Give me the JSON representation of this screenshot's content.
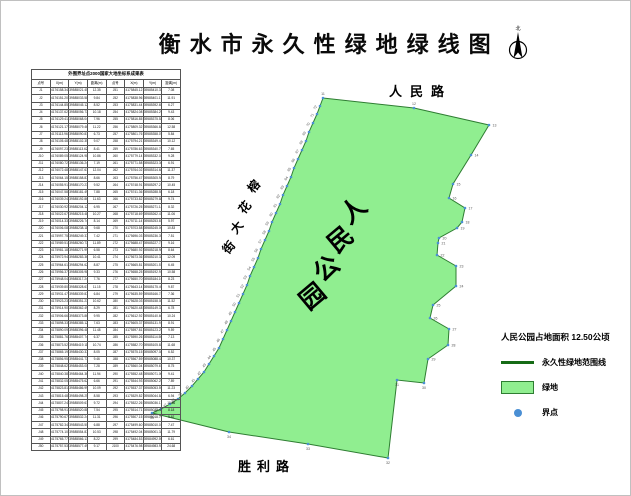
{
  "title": "衡水市永久性绿地绿线图",
  "north": {
    "label": "北"
  },
  "map": {
    "road_top": "人民路",
    "road_bottom": "胜利路",
    "street_left": "榕花大街",
    "street_chars": [
      {
        "ch": "榕",
        "x": 256,
        "y": 188
      },
      {
        "ch": "花",
        "x": 247,
        "y": 209
      },
      {
        "ch": "大",
        "x": 239,
        "y": 229
      },
      {
        "ch": "街",
        "x": 231,
        "y": 249
      }
    ],
    "park_name": "人民公园",
    "park_chars": [
      {
        "ch": "人",
        "x": 358,
        "y": 216
      },
      {
        "ch": "民",
        "x": 345,
        "y": 245
      },
      {
        "ch": "公",
        "x": 331,
        "y": 274
      },
      {
        "ch": "园",
        "x": 317,
        "y": 302
      }
    ],
    "polygon_points": "322,97 413,107 488,124 470,154 452,183 448,197 464,207 461,221 456,227 438,237 437,242 436,254 455,265 455,285 432,304 429,317 448,328 447,344 427,358 423,382 396,379 387,457 307,443 228,431 151,412 160,408 169,403 177,398 184,392 191,385 197,378 203,371 208,363 213,355 218,347 222,338 226,329 230,320 234,311 238,302 242,293 246,284 249,275 253,266 257,257 260,248 264,239 268,230 271,221 275,212 279,203 282,194 286,185 290,176 293,167 297,158 301,149 305,140 308,131 312,122 316,113 319,105",
    "fill_color": "#90ee90",
    "stroke_color": "#2e7d32",
    "dot_color": "#4a8fd4",
    "points": [
      [
        322,
        97,
        "11",
        "t"
      ],
      [
        413,
        107,
        "12",
        "t"
      ],
      [
        488,
        124,
        "13",
        "r"
      ],
      [
        470,
        154,
        "14",
        "r"
      ],
      [
        452,
        183,
        "15",
        "r"
      ],
      [
        448,
        197,
        "16",
        "r"
      ],
      [
        464,
        207,
        "17",
        "r"
      ],
      [
        461,
        221,
        "18",
        "r"
      ],
      [
        456,
        227,
        "19",
        "r"
      ],
      [
        438,
        237,
        "20",
        "r"
      ],
      [
        437,
        242,
        "21",
        "r"
      ],
      [
        436,
        254,
        "22",
        "r"
      ],
      [
        455,
        265,
        "23",
        "r"
      ],
      [
        455,
        285,
        "24",
        "r"
      ],
      [
        432,
        304,
        "25",
        "r"
      ],
      [
        429,
        317,
        "26",
        "r"
      ],
      [
        448,
        328,
        "27",
        "r"
      ],
      [
        447,
        344,
        "28",
        "r"
      ],
      [
        427,
        358,
        "29",
        "r"
      ],
      [
        423,
        382,
        "30",
        "b"
      ],
      [
        396,
        379,
        "31",
        "b"
      ],
      [
        387,
        457,
        "32",
        "b"
      ],
      [
        307,
        443,
        "33",
        "b"
      ],
      [
        228,
        431,
        "34",
        "b"
      ],
      [
        151,
        412,
        "35",
        "b"
      ],
      [
        160,
        408,
        "36",
        "rot"
      ],
      [
        169,
        403,
        "37",
        "rot"
      ],
      [
        177,
        398,
        "38",
        "rot"
      ],
      [
        184,
        392,
        "39",
        "rot"
      ],
      [
        191,
        385,
        "40",
        "rot"
      ],
      [
        197,
        378,
        "41",
        "rot"
      ],
      [
        203,
        371,
        "42",
        "rot"
      ],
      [
        208,
        363,
        "43",
        "rot"
      ],
      [
        213,
        355,
        "44",
        "rot"
      ],
      [
        218,
        347,
        "45",
        "rot"
      ],
      [
        222,
        338,
        "46",
        "rot"
      ],
      [
        226,
        329,
        "47",
        "rot"
      ],
      [
        230,
        320,
        "48",
        "rot"
      ],
      [
        234,
        311,
        "49",
        "rot"
      ],
      [
        238,
        302,
        "50",
        "rot"
      ],
      [
        242,
        293,
        "51",
        "rot"
      ],
      [
        246,
        284,
        "52",
        "rot"
      ],
      [
        249,
        275,
        "53",
        "rot"
      ],
      [
        253,
        266,
        "54",
        "rot"
      ],
      [
        257,
        257,
        "55",
        "rot"
      ],
      [
        260,
        248,
        "56",
        "rot"
      ],
      [
        264,
        239,
        "57",
        "rot"
      ],
      [
        268,
        230,
        "58",
        "rot"
      ],
      [
        271,
        221,
        "59",
        "rot"
      ],
      [
        275,
        212,
        "60",
        "rot"
      ],
      [
        279,
        203,
        "61",
        "rot"
      ],
      [
        282,
        194,
        "62",
        "rot"
      ],
      [
        286,
        185,
        "63",
        "rot"
      ],
      [
        290,
        176,
        "64",
        "rot"
      ],
      [
        293,
        167,
        "65",
        "rot"
      ],
      [
        297,
        158,
        "66",
        "rot"
      ],
      [
        301,
        149,
        "67",
        "rot"
      ],
      [
        305,
        140,
        "68",
        "rot"
      ],
      [
        308,
        131,
        "69",
        "rot"
      ],
      [
        312,
        122,
        "70",
        "rot"
      ],
      [
        316,
        113,
        "71",
        "rot"
      ],
      [
        319,
        105,
        "72",
        "rot"
      ]
    ]
  },
  "legend": {
    "area_note": "人民公园占地面积  12.50公顷",
    "items": [
      {
        "type": "line",
        "label": "永久性绿地范围线",
        "color": "#166b16"
      },
      {
        "type": "fill",
        "label": "绿地",
        "color": "#90ee90"
      },
      {
        "type": "dot",
        "label": "界点",
        "color": "#4a8fd4"
      }
    ]
  },
  "table": {
    "title": "外围界址点2000国家大地坐标系成果表",
    "headers": [
      "点号",
      "X(m)",
      "Y(m)",
      "距离(m)"
    ],
    "rows": [
      [
        "J1",
        "4176158.34",
        "39585021.45",
        "12.35",
        "J51",
        "4175845.12",
        "39585410.33",
        "7.08"
      ],
      [
        "J2",
        "4176151.20",
        "39585033.58",
        "9.84",
        "J52",
        "4175838.96",
        "39585401.17",
        "11.91"
      ],
      [
        "J3",
        "4176144.85",
        "39585045.12",
        "8.52",
        "J53",
        "4175831.44",
        "39585392.65",
        "6.27"
      ],
      [
        "J4",
        "4176137.62",
        "39585056.73",
        "10.18",
        "J54",
        "4175824.08",
        "39585384.29",
        "9.43"
      ],
      [
        "J5",
        "4176129.41",
        "39585068.04",
        "7.96",
        "J55",
        "4175816.85",
        "39585375.52",
        "8.06"
      ],
      [
        "J6",
        "4176121.17",
        "39585079.46",
        "11.22",
        "J56",
        "4175809.32",
        "39585366.84",
        "12.58"
      ],
      [
        "J7",
        "4176113.96",
        "39585090.81",
        "6.73",
        "J57",
        "4175801.76",
        "39585358.07",
        "5.84"
      ],
      [
        "J8",
        "4176105.48",
        "39585102.35",
        "9.07",
        "J58",
        "4175794.21",
        "39585349.41",
        "10.12"
      ],
      [
        "J9",
        "4176097.23",
        "39585113.62",
        "8.41",
        "J59",
        "4175786.63",
        "39585340.75",
        "7.65"
      ],
      [
        "J10",
        "4176089.05",
        "39585124.98",
        "10.86",
        "J60",
        "4175779.14",
        "39585332.02",
        "9.28"
      ],
      [
        "J11",
        "4176080.72",
        "39585136.24",
        "7.19",
        "J61",
        "4175771.58",
        "39585323.36",
        "6.91"
      ],
      [
        "J12",
        "4176072.48",
        "39585147.61",
        "12.04",
        "J62",
        "4175764.02",
        "39585314.68",
        "11.37"
      ],
      [
        "J13",
        "4176064.15",
        "39585158.87",
        "8.66",
        "J63",
        "4175756.47",
        "39585305.94",
        "8.79"
      ],
      [
        "J14",
        "4176055.91",
        "39585170.23",
        "9.52",
        "J64",
        "4175748.91",
        "39585297.21",
        "10.45"
      ],
      [
        "J15",
        "4176047.58",
        "39585181.49",
        "7.88",
        "J65",
        "4175741.36",
        "39585288.55",
        "6.18"
      ],
      [
        "J16",
        "4176039.24",
        "39585192.86",
        "11.63",
        "J66",
        "4175733.82",
        "39585279.88",
        "9.74"
      ],
      [
        "J17",
        "4176030.92",
        "39585204.12",
        "6.95",
        "J67",
        "4175726.25",
        "39585271.14",
        "8.32"
      ],
      [
        "J18",
        "4176022.67",
        "39585215.48",
        "10.27",
        "J68",
        "4175718.69",
        "39585262.47",
        "11.06"
      ],
      [
        "J19",
        "4176014.33",
        "39585226.74",
        "8.14",
        "J69",
        "4175711.14",
        "39585253.81",
        "5.97"
      ],
      [
        "J20",
        "4176006.08",
        "39585238.11",
        "9.68",
        "J70",
        "4175703.58",
        "39585245.06",
        "10.83"
      ],
      [
        "J21",
        "4175997.75",
        "39585249.37",
        "7.42",
        "J71",
        "4175696.03",
        "39585236.39",
        "7.51"
      ],
      [
        "J22",
        "4175989.51",
        "39585260.73",
        "11.89",
        "J72",
        "4175688.47",
        "39585227.73",
        "9.16"
      ],
      [
        "J23",
        "4175981.18",
        "39585271.99",
        "6.58",
        "J73",
        "4175680.92",
        "39585218.98",
        "8.64"
      ],
      [
        "J24",
        "4175972.94",
        "39585283.36",
        "10.41",
        "J74",
        "4175673.36",
        "39585210.32",
        "12.09"
      ],
      [
        "J25",
        "4175964.61",
        "39585294.62",
        "8.87",
        "J75",
        "4175665.81",
        "39585201.57",
        "6.45"
      ],
      [
        "J26",
        "4175956.37",
        "39585305.98",
        "9.33",
        "J76",
        "4175658.25",
        "39585192.91",
        "10.58"
      ],
      [
        "J27",
        "4175948.04",
        "39585317.24",
        "7.76",
        "J77",
        "4175650.70",
        "39585184.16",
        "8.23"
      ],
      [
        "J28",
        "4175939.80",
        "39585328.61",
        "11.15",
        "J78",
        "4175643.14",
        "39585175.49",
        "9.87"
      ],
      [
        "J29",
        "4175931.47",
        "39585339.87",
        "6.84",
        "J79",
        "4175635.59",
        "39585166.74",
        "7.36"
      ],
      [
        "J30",
        "4175923.23",
        "39585351.23",
        "10.62",
        "J80",
        "4175628.03",
        "39585158.08",
        "11.52"
      ],
      [
        "J31",
        "4175914.90",
        "39585362.49",
        "8.29",
        "J81",
        "4175620.48",
        "39585149.33",
        "6.78"
      ],
      [
        "J32",
        "4175906.66",
        "39585373.86",
        "9.95",
        "J82",
        "4175612.92",
        "39585140.66",
        "10.24"
      ],
      [
        "J33",
        "4175898.33",
        "39585385.12",
        "7.63",
        "J83",
        "4175605.37",
        "39585131.91",
        "8.91"
      ],
      [
        "J34",
        "4175890.09",
        "39585396.48",
        "11.48",
        "J84",
        "4175597.81",
        "39585123.25",
        "9.59"
      ],
      [
        "J35",
        "4175881.76",
        "39585407.74",
        "6.37",
        "J85",
        "4175590.26",
        "39585114.50",
        "7.13"
      ],
      [
        "J36",
        "4175873.52",
        "39585419.11",
        "10.74",
        "J86",
        "4175582.70",
        "39585105.83",
        "11.68"
      ],
      [
        "J37",
        "4175865.19",
        "39585430.37",
        "8.05",
        "J87",
        "4175575.15",
        "39585097.08",
        "6.52"
      ],
      [
        "J38",
        "4175856.95",
        "39585441.73",
        "9.46",
        "J88",
        "4175567.59",
        "39585088.42",
        "10.37"
      ],
      [
        "J39",
        "4175848.62",
        "39585453.00",
        "7.28",
        "J89",
        "4175560.04",
        "39585079.67",
        "8.75"
      ],
      [
        "J40",
        "4175840.38",
        "39585464.36",
        "11.94",
        "J90",
        "4175552.48",
        "39585071.00",
        "9.41"
      ],
      [
        "J41",
        "4175832.05",
        "39585475.62",
        "6.66",
        "J91",
        "4175544.93",
        "39585062.25",
        "7.89"
      ],
      [
        "J42",
        "4175823.81",
        "39585486.99",
        "10.09",
        "J92",
        "4175537.37",
        "39585053.59",
        "11.23"
      ],
      [
        "J43",
        "4175815.48",
        "39585498.25",
        "8.58",
        "J93",
        "4175529.82",
        "39585044.84",
        "6.94"
      ],
      [
        "J44",
        "4175807.24",
        "39585509.61",
        "9.72",
        "J94",
        "4175522.26",
        "39585036.17",
        "10.66"
      ],
      [
        "J45",
        "4175798.91",
        "39585520.88",
        "7.54",
        "J95",
        "4175514.71",
        "39585027.42",
        "8.18"
      ],
      [
        "J46",
        "4175790.67",
        "39585532.24",
        "11.31",
        "J96",
        "4175507.15",
        "39585018.76",
        "9.62"
      ],
      [
        "J47",
        "4175782.34",
        "39585543.50",
        "6.88",
        "J97",
        "4175499.60",
        "39585010.01",
        "7.47"
      ],
      [
        "J48",
        "4175774.10",
        "39585554.87",
        "10.53",
        "J98",
        "4175492.04",
        "39585001.34",
        "11.79"
      ],
      [
        "J49",
        "4175765.77",
        "39585566.13",
        "8.22",
        "J99",
        "4175484.53",
        "39584992.59",
        "6.61"
      ],
      [
        "J50",
        "4175757.53",
        "39585577.49",
        "9.17",
        "J100",
        "4175476.98",
        "39584983.93",
        "24.68"
      ]
    ]
  }
}
